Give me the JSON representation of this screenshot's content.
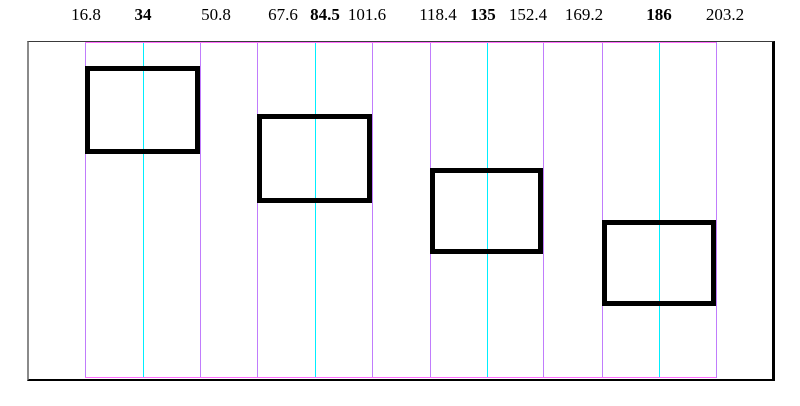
{
  "diagram": {
    "canvas": {
      "width": 800,
      "height": 406
    },
    "colors": {
      "violet": "#c07cfc",
      "cyan": "#00eeff",
      "magenta": "#ff70ff",
      "black": "#000000"
    },
    "frame": {
      "x": 27,
      "y": 41,
      "width": 748,
      "height": 340
    },
    "top_labels": [
      {
        "text": "16.8",
        "x": 86,
        "bold": false
      },
      {
        "text": "34",
        "x": 143,
        "bold": true
      },
      {
        "text": "50.8",
        "x": 216,
        "bold": false
      },
      {
        "text": "67.6",
        "x": 283,
        "bold": false
      },
      {
        "text": "84.5",
        "x": 325,
        "bold": true
      },
      {
        "text": "101.6",
        "x": 367,
        "bold": false
      },
      {
        "text": "118.4",
        "x": 438,
        "bold": false
      },
      {
        "text": "135",
        "x": 483,
        "bold": true
      },
      {
        "text": "152.4",
        "x": 528,
        "bold": false
      },
      {
        "text": "169.2",
        "x": 584,
        "bold": false
      },
      {
        "text": "186",
        "x": 659,
        "bold": true
      },
      {
        "text": "203.2",
        "x": 725,
        "bold": false
      }
    ],
    "vertical_lines": [
      {
        "x": 85,
        "color": "violet"
      },
      {
        "x": 143,
        "color": "cyan"
      },
      {
        "x": 200,
        "color": "violet"
      },
      {
        "x": 257,
        "color": "violet"
      },
      {
        "x": 315,
        "color": "cyan"
      },
      {
        "x": 372,
        "color": "violet"
      },
      {
        "x": 430,
        "color": "violet"
      },
      {
        "x": 487,
        "color": "cyan"
      },
      {
        "x": 543,
        "color": "violet"
      },
      {
        "x": 602,
        "color": "violet"
      },
      {
        "x": 659,
        "color": "cyan"
      },
      {
        "x": 716,
        "color": "violet"
      }
    ],
    "lines_top": 42,
    "lines_bottom": 378,
    "horizontal_lines": [
      {
        "y": 42,
        "x1": 85,
        "x2": 716,
        "color": "magenta"
      },
      {
        "y": 377,
        "x1": 85,
        "x2": 716,
        "color": "magenta"
      }
    ],
    "boxes": [
      {
        "x": 85,
        "y": 66,
        "width": 115,
        "height": 88
      },
      {
        "x": 257,
        "y": 114,
        "width": 115,
        "height": 89
      },
      {
        "x": 430,
        "y": 168,
        "width": 113,
        "height": 86
      },
      {
        "x": 602,
        "y": 220,
        "width": 114,
        "height": 86
      }
    ]
  }
}
